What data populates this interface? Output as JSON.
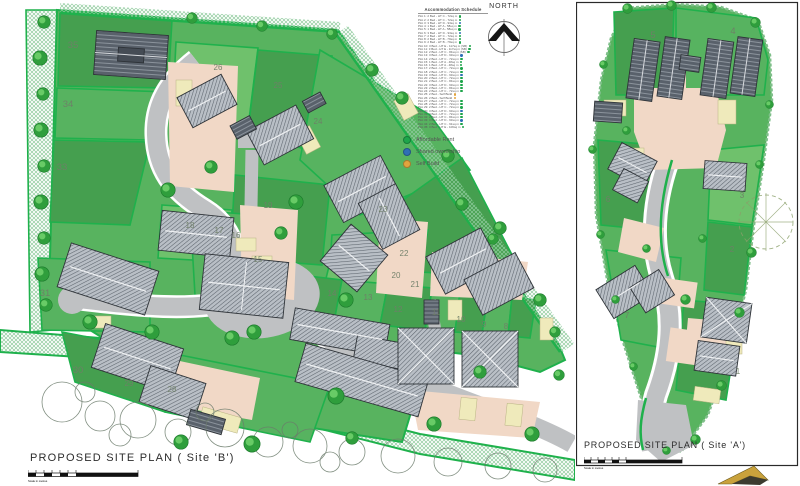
{
  "document": {
    "north_label": "NORTH",
    "schedule": {
      "title": "Accommodation Schedule",
      "rows": [
        {
          "text": "Plot 1: 2 Bed - HT C - 72sq m",
          "dot": "#1ea54b"
        },
        {
          "text": "Plot 2: 2 Bed - HT C - 72sq m",
          "dot": "#1ea54b"
        },
        {
          "text": "Plot 3: 3 Bed - HT D - 93sq m",
          "dot": "#2f6fb5"
        },
        {
          "text": "Plot 4: 1 Bed - HT A - 58sq m",
          "dot": "#1ea54b"
        },
        {
          "text": "Plot 5: 1 Bed - HT A - 58sq m",
          "dot": "#1ea54b"
        },
        {
          "text": "Plot 6: 3 Bed - HT D - 93sq m",
          "dot": "#2f6fb5"
        },
        {
          "text": "Plot 7: 2 Bed - HT C - 72sq m",
          "dot": "#1ea54b"
        },
        {
          "text": "Plot 8: 2 Bed - HT B - 79sq m",
          "dot": "#1ea54b"
        },
        {
          "text": "Plot 9: 2 Bed - HT B - 79sq m",
          "dot": "#1ea54b"
        },
        {
          "text": "Plot 10: 3 Bed - HT E - 117sq m (SB)",
          "dot": "#1ea54b"
        },
        {
          "text": "Plot 11: 3 Bed - HT E - 117sq m (SB)",
          "dot": "#1ea54b"
        },
        {
          "text": "Plot 12: 2 Bed - HT C - 84sq m (SB)",
          "dot": "#1ea54b"
        },
        {
          "text": "Plot 13: 3 Bed - HT D - 93sq m",
          "dot": "#2f6fb5"
        },
        {
          "text": "Plot 14: 2 Bed - HT C - 72sq m",
          "dot": "#1ea54b"
        },
        {
          "text": "Plot 15: 1 Bed - HT A - 48sq m",
          "dot": "#1ea54b"
        },
        {
          "text": "Plot 16: 1 Bed - HT A - 48sq m",
          "dot": "#1ea54b"
        },
        {
          "text": "Plot 17: 2 Bed - HT C - 72sq m",
          "dot": "#1ea54b"
        },
        {
          "text": "Plot 18: 2 Bed - HT C - 72sq m",
          "dot": "#1ea54b"
        },
        {
          "text": "Plot 19: 3 Bed - HT D - 93sq m",
          "dot": "#2f6fb5"
        },
        {
          "text": "Plot 20: 2 Bed - HT C - 72sq m",
          "dot": "#1ea54b"
        },
        {
          "text": "Plot 21: 2 Bed - HT C - 84sq m",
          "dot": "#1ea54b"
        },
        {
          "text": "Plot 22: 3 Bed - HT D - 93sq m",
          "dot": "#1ea54b"
        },
        {
          "text": "Plot 23: 2 Bed - HT C - 84sq m",
          "dot": "#1ea54b"
        },
        {
          "text": "Plot 24: 2 Bed - HT C - 72sq m",
          "dot": "#1ea54b"
        },
        {
          "text": "Plot 25: 2 Bed - Self Build",
          "dot": "#e2a43e"
        },
        {
          "text": "Plot 26: 2 Bed - Self Build",
          "dot": "#e2a43e"
        },
        {
          "text": "Plot 27: 2 Bed - HT C - 72sq m",
          "dot": "#1ea54b"
        },
        {
          "text": "Plot 28: 2 Bed - HT C - 72sq m",
          "dot": "#1ea54b"
        },
        {
          "text": "Plot 29: 2 Bed - HT C - 72sq m",
          "dot": "#1ea54b"
        },
        {
          "text": "Plot 30: 3 Bed - HT D - 93sq m",
          "dot": "#2f6fb5"
        },
        {
          "text": "Plot 31: 2 Bed - HT C - 72sq m",
          "dot": "#1ea54b"
        },
        {
          "text": "Plot 32: 2 Bed - HT C - 84sq m",
          "dot": "#1ea54b"
        },
        {
          "text": "Plot 33: 3 Bed - HT D - 93sq m",
          "dot": "#2f6fb5"
        },
        {
          "text": "Plot 34: 2 Bed - HT C - 91sq m",
          "dot": "#1ea54b"
        },
        {
          "text": "Plot 35: 3 Bed - HT E - 106sq m",
          "dot": "#1ea54b"
        }
      ]
    },
    "legend": {
      "items": [
        {
          "label": "Affordable Rent",
          "color": "#1ea54b"
        },
        {
          "label": "Shared ownership",
          "color": "#2f6fb5"
        },
        {
          "label": "Self Build",
          "color": "#e2a43e"
        }
      ]
    },
    "site_b": {
      "title": "PROPOSED SITE PLAN  ( Site 'B')",
      "scale_note": "Scale in metres",
      "plots": [
        {
          "n": "35",
          "x": 73,
          "y": 48,
          "s": 1
        },
        {
          "n": "34",
          "x": 68,
          "y": 107,
          "s": 1
        },
        {
          "n": "33",
          "x": 62,
          "y": 170,
          "s": 1
        },
        {
          "n": "31",
          "x": 45,
          "y": 296,
          "s": 1
        },
        {
          "n": "30",
          "x": 78,
          "y": 373,
          "s": 1
        },
        {
          "n": "29",
          "x": 129,
          "y": 386
        },
        {
          "n": "28",
          "x": 172,
          "y": 392
        },
        {
          "n": "26",
          "x": 218,
          "y": 70
        },
        {
          "n": "25",
          "x": 278,
          "y": 88
        },
        {
          "n": "24",
          "x": 318,
          "y": 124
        },
        {
          "n": "23",
          "x": 383,
          "y": 212
        },
        {
          "n": "19",
          "x": 268,
          "y": 208
        },
        {
          "n": "18",
          "x": 190,
          "y": 228
        },
        {
          "n": "17",
          "x": 219,
          "y": 233
        },
        {
          "n": "16",
          "x": 236,
          "y": 238
        },
        {
          "n": "15",
          "x": 258,
          "y": 262
        },
        {
          "n": "22",
          "x": 404,
          "y": 256
        },
        {
          "n": "20",
          "x": 396,
          "y": 278
        },
        {
          "n": "21",
          "x": 415,
          "y": 287
        },
        {
          "n": "14",
          "x": 332,
          "y": 296
        },
        {
          "n": "13",
          "x": 368,
          "y": 300
        },
        {
          "n": "12",
          "x": 398,
          "y": 312
        },
        {
          "n": "11",
          "x": 436,
          "y": 315
        },
        {
          "n": "10",
          "x": 461,
          "y": 322
        },
        {
          "n": "9",
          "x": 484,
          "y": 327
        },
        {
          "n": "8",
          "x": 506,
          "y": 329
        }
      ]
    },
    "site_a": {
      "title": "PROPOSED SITE PLAN  ( Site 'A')",
      "scale_note": "Scale in metres",
      "plots": [
        {
          "n": "5",
          "x": 77,
          "y": 38,
          "s": 1
        },
        {
          "n": "4",
          "x": 157,
          "y": 34,
          "s": 1
        },
        {
          "n": "6",
          "x": 32,
          "y": 202
        },
        {
          "n": "3",
          "x": 166,
          "y": 198
        },
        {
          "n": "2",
          "x": 156,
          "y": 252
        },
        {
          "n": "7",
          "x": 51,
          "y": 318
        },
        {
          "n": "1",
          "x": 162,
          "y": 374
        }
      ]
    }
  },
  "colors": {
    "site_green": "#58b35f",
    "parcel_dark": "#459f4f",
    "parcel_mid": "#57b360",
    "parcel_light": "#6fc16c",
    "edge_green": "#1fb14c",
    "hatch_green": "#8fcb9d",
    "road_gray": "#bfc1c3",
    "drive_peach": "#f1d8c6",
    "pad_cream": "#efeabb",
    "building_dark": "#59616b",
    "building_light": "#c9ced3",
    "tree_green": "#2f9e3c",
    "affordable_rent": "#1ea54b",
    "shared_ownership": "#2f6fb5",
    "self_build": "#e2a43e"
  }
}
